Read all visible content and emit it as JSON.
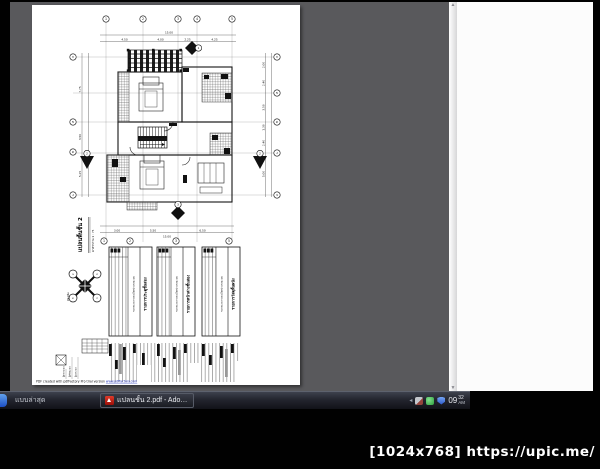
{
  "watermark": {
    "text": "[1024x768] https://upic.me/"
  },
  "taskbar": {
    "task1_label": "แบบล่าสุด",
    "task2_label": "แปลนชั้น 2.pdf - Adob...",
    "clock": {
      "hour": "09",
      "minute": "32",
      "ampm": "AM"
    }
  },
  "page": {
    "plan_title": "แปลนพื้นชั้น 2",
    "plan_scale": "มาตราส่วน 1 : 75",
    "compass_label": "ทิศเหนือ",
    "compass_points": [
      "น",
      "อ",
      "ต",
      "ก"
    ],
    "footer_prefix": "PDF created with pdfFactory Pro trial version ",
    "footer_link": "www.pdffactory.com",
    "grid_top": [
      "1",
      "2",
      "3",
      "4",
      "5"
    ],
    "grid_bottom": [
      "1",
      "2",
      "3",
      "5"
    ],
    "grid_left": [
      "ก",
      "ข",
      "ค",
      "ง"
    ],
    "grid_right": [
      "ก",
      "ข",
      "ค",
      "ง",
      "จ"
    ],
    "dims": {
      "top_total": "15.00",
      "top": [
        "4.50",
        "4.00",
        "2.25",
        "4.25"
      ],
      "bottom": [
        "3.00",
        "5.50",
        "6.50"
      ],
      "bottom_total": "15.00",
      "left": [
        "7.75",
        "3.50",
        "5.25"
      ],
      "right": [
        "2.00",
        "2.40",
        "3.50",
        "1.30",
        "2.40",
        "5.00"
      ]
    },
    "section_markers": [
      "1",
      "2",
      "2",
      "3"
    ],
    "tables": [
      {
        "title": "รายการประตูชั้นสอง",
        "subtitle": "ขนาดและรายละเอียดประกอบแบบ"
      },
      {
        "title": "รายการหน้าต่างชั้นสอง",
        "subtitle": "ขนาดและรายละเอียดประกอบแบบ"
      },
      {
        "title": "รายการวัสดุพื้นผนัง",
        "subtitle": "ขนาดและรายละเอียดประกอบแบบ"
      }
    ],
    "titleblock": {
      "labels": [
        "ผู้ออกแบบ",
        "ผู้เขียนแบบ",
        "ผู้ตรวจแบบ"
      ]
    }
  }
}
